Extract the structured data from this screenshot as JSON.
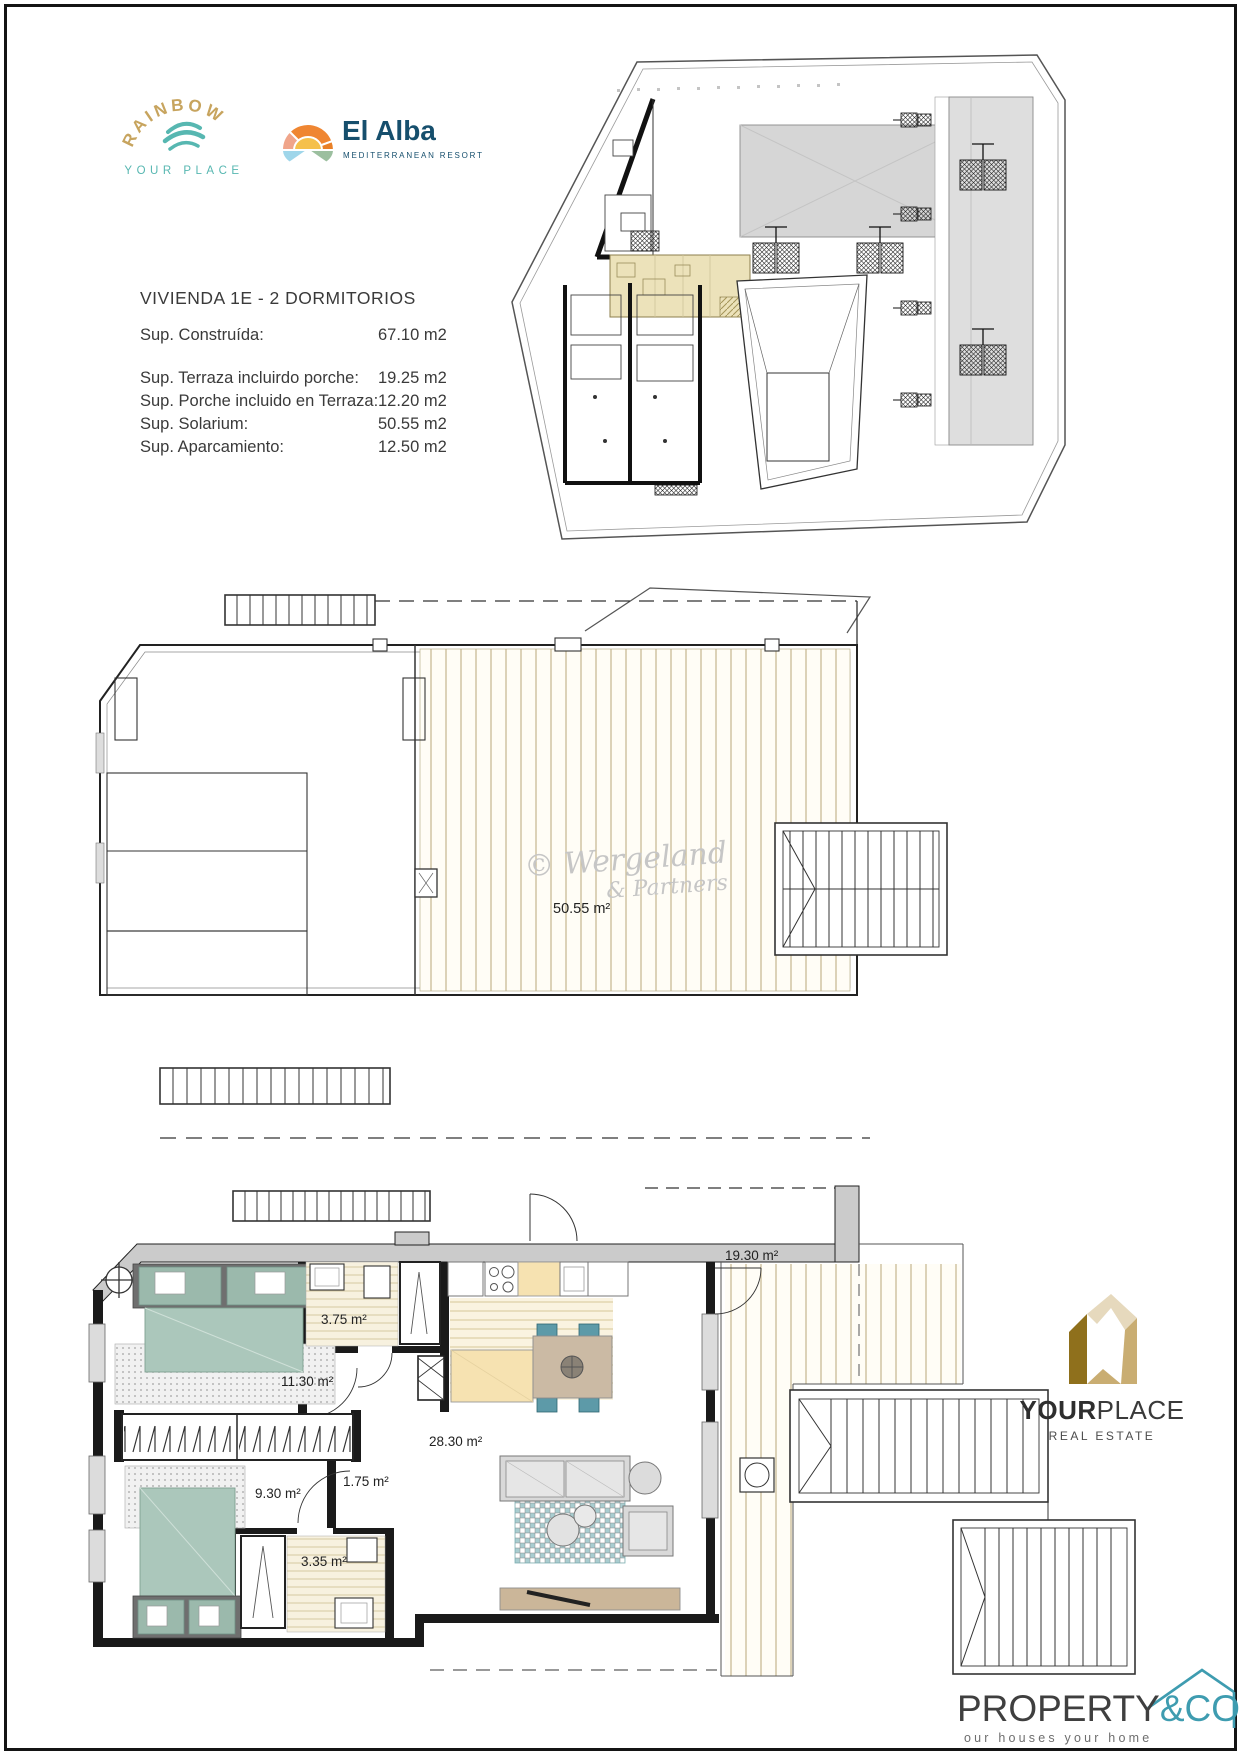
{
  "document": {
    "title": "VIVIENDA 1E - 2 DORMITORIOS",
    "areas": [
      {
        "label": "Sup. Construída:",
        "value": "67.10 m2"
      },
      {
        "label": "Sup. Terraza incluirdo porche:",
        "value": "19.25 m2"
      },
      {
        "label": "Sup. Porche incluido en Terraza:",
        "value": "12.20 m2"
      },
      {
        "label": "Sup. Solarium:",
        "value": "50.55 m2"
      },
      {
        "label": "Sup. Aparcamiento:",
        "value": "12.50 m2"
      }
    ]
  },
  "brands": {
    "rainbow": {
      "name": "RAINBOW",
      "tagline": "YOUR PLACE"
    },
    "el_alba": {
      "name": "El Alba",
      "tagline": "MEDITERRANEAN RESORT"
    },
    "yourplace": {
      "name_bold": "YOUR",
      "name_light": "PLACE",
      "tagline": "REAL ESTATE"
    },
    "property_co": {
      "name": "PROPERTY",
      "suffix": "&CO",
      "tagline": "our houses your home"
    }
  },
  "plans": {
    "solarium": {
      "area_label": "50.55 m²",
      "watermark_line1": "© Wergeland",
      "watermark_line2": "& Partners"
    },
    "main_floor": {
      "rooms": [
        {
          "name": "bathroom-1",
          "area_label": "3.75 m²"
        },
        {
          "name": "bedroom-1",
          "area_label": "11.30 m²"
        },
        {
          "name": "bedroom-2",
          "area_label": "9.30 m²"
        },
        {
          "name": "hallway",
          "area_label": "1.75 m²"
        },
        {
          "name": "bathroom-2",
          "area_label": "3.35 m²"
        },
        {
          "name": "living-kitchen",
          "area_label": "28.30 m²"
        },
        {
          "name": "terrace",
          "area_label": "19.30 m²"
        }
      ]
    }
  },
  "colors": {
    "rainbow_gold": "#c7a45e",
    "rainbow_teal": "#57b7b1",
    "el_alba_navy": "#164f6d",
    "highlight_unit_beige": "#ece2ba",
    "bed_sage": "#abc7bb",
    "chair_teal": "#5d9aa8",
    "counter_beige": "#f6e2b1",
    "yourplace_gold": "#8f701c",
    "property_co_teal": "#3e9cb0"
  }
}
